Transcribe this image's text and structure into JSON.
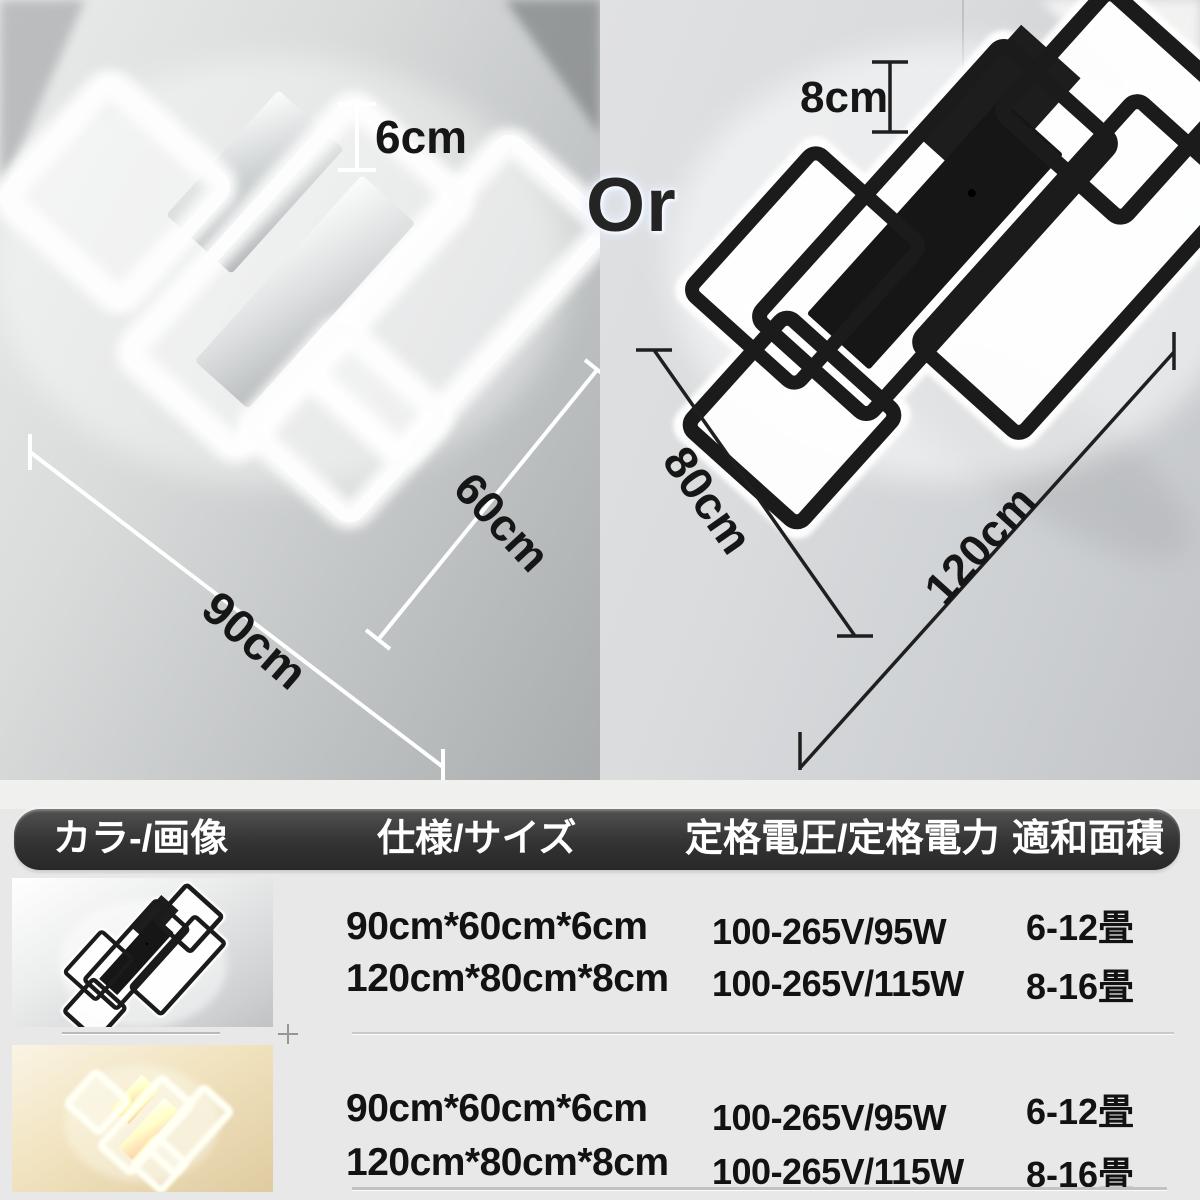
{
  "or_label": "Or",
  "left_product": {
    "variant": "white",
    "height_label": "6cm",
    "length_label": "90cm",
    "width_label": "60cm"
  },
  "right_product": {
    "variant": "black",
    "height_label": "8cm",
    "length_label": "120cm",
    "width_label": "80cm"
  },
  "spec_table": {
    "headers": [
      "カラ-/画像",
      "仕様/サイズ",
      "定格電圧/定格電力",
      "適和面積"
    ],
    "rows": [
      {
        "variant": "black",
        "options": [
          {
            "size": "90cm*60cm*6cm",
            "power": "100-265V/95W",
            "area": "6-12畳"
          },
          {
            "size": "120cm*80cm*8cm",
            "power": "100-265V/115W",
            "area": "8-16畳"
          }
        ]
      },
      {
        "variant": "white-warm",
        "options": [
          {
            "size": "90cm*60cm*6cm",
            "power": "100-265V/95W",
            "area": "6-12畳"
          },
          {
            "size": "120cm*80cm*8cm",
            "power": "100-265V/115W",
            "area": "8-16畳"
          }
        ]
      }
    ]
  },
  "colors": {
    "header_bar": "#333333",
    "header_text": "#ffffff",
    "spec_text": "#121212",
    "table_bg": "#e8e8e8",
    "dim_line_left": "#ffffff",
    "dim_line_right": "#1f1f1f",
    "warm_glow": "#f0dcae",
    "cool_glow": "#ffffff"
  }
}
